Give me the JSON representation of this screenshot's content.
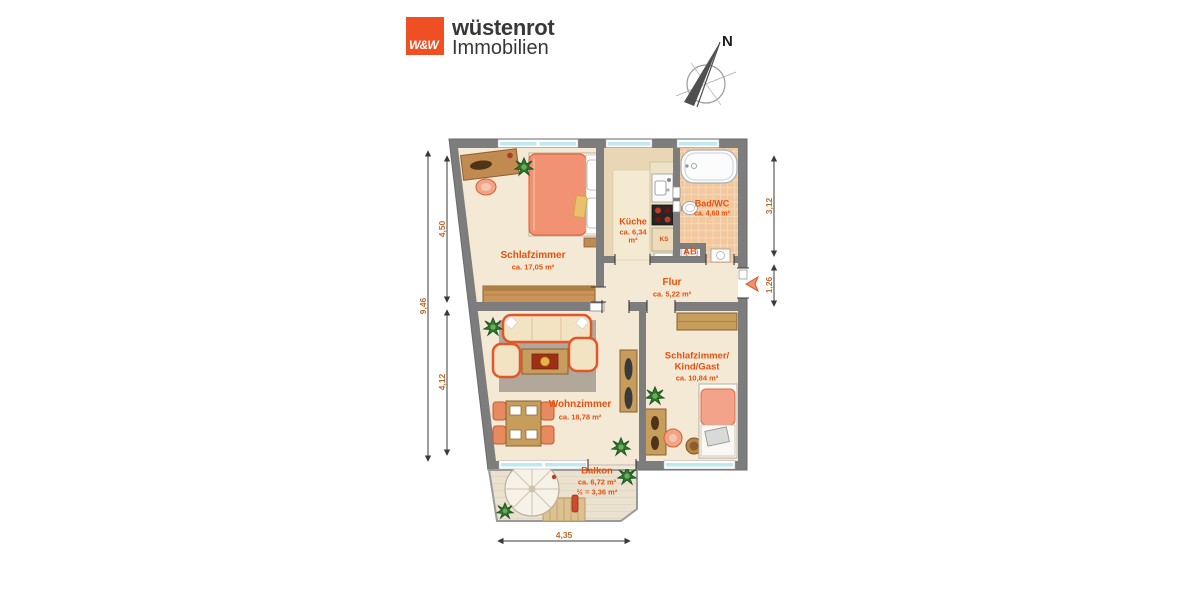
{
  "brand": {
    "monogram": "W&W",
    "name": "wüstenrot",
    "division": "Immobilien",
    "accent_color": "#f04e23"
  },
  "compass": {
    "north_label": "N"
  },
  "floor_plan": {
    "rooms": {
      "schlafzimmer": {
        "name": "Schlafzimmer",
        "area": "ca. 17,05 m²"
      },
      "kueche": {
        "name": "Küche",
        "area_line1": "ca. 6,34",
        "area_line2": "m²"
      },
      "bad_wc": {
        "name": "Bad/WC",
        "area": "ca. 4,60 m²"
      },
      "flur": {
        "name": "Flur",
        "area": "ca. 5,22 m²"
      },
      "kind_gast": {
        "name_line1": "Schlafzimmer/",
        "name_line2": "Kind/Gast",
        "area": "ca. 10,84 m²"
      },
      "wohnzimmer": {
        "name": "Wohnzimmer",
        "area": "ca. 18,78 m²"
      },
      "balkon": {
        "name": "Balkon",
        "area": "ca. 6,72 m²",
        "area_half": "½ = 3,36 m²"
      }
    },
    "annotations": {
      "fridge": "KS",
      "storage": "AB"
    },
    "dimensions": {
      "left_total": "9,46",
      "left_upper": "4,50",
      "left_lower": "4,12",
      "right_upper": "3,12",
      "right_lower": "1,26",
      "bottom": "4,35"
    },
    "colors": {
      "wall": "#7d7d7d",
      "floor": "#f3e9d4",
      "label": "#e8500f"
    }
  }
}
